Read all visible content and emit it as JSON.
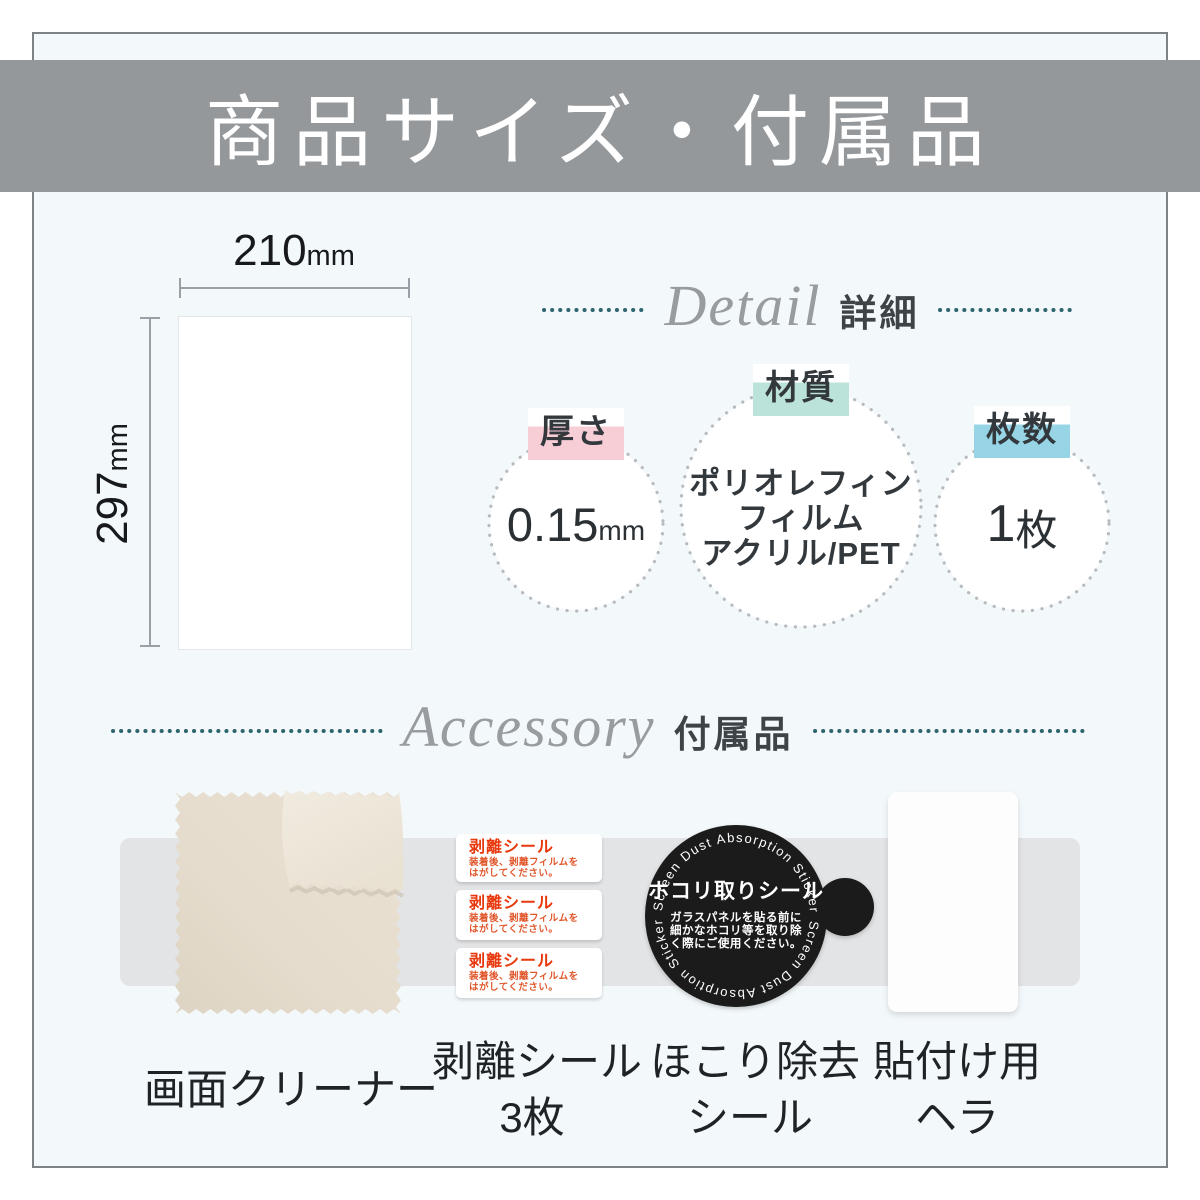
{
  "title": "商品サイズ・付属品",
  "size_diagram": {
    "width_value": "210",
    "width_unit": "mm",
    "height_value": "297",
    "height_unit": "mm"
  },
  "detail": {
    "script_title": "Detail",
    "heading": "詳細",
    "specs": [
      {
        "label": "厚さ",
        "value": "0.15",
        "unit": "mm",
        "highlight_color": "#f7cdd6"
      },
      {
        "label": "材質",
        "lines": [
          "ポリオレフィン",
          "フィルム",
          "アクリル/PET"
        ],
        "highlight_color": "#bce3d9"
      },
      {
        "label": "枚数",
        "value": "1",
        "unit": "枚",
        "highlight_color": "#97d4e5"
      }
    ]
  },
  "accessory": {
    "script_title": "Accessory",
    "heading": "付属品",
    "items": [
      {
        "line1": "画面クリーナー",
        "line2": ""
      },
      {
        "line1": "剥離シール",
        "line2": "3枚"
      },
      {
        "line1": "ほこり除去",
        "line2": "シール"
      },
      {
        "line1": "貼付け用",
        "line2": "ヘラ"
      }
    ]
  },
  "release_sticker": {
    "title": "剥離シール",
    "body_line1": "装着後、剥離フィルムを",
    "body_line2": "はがしてください。"
  },
  "dust_sticker": {
    "curved_text": "Screen Dust Absorption Sticker",
    "title": "ホコリ取りシール",
    "body_lines": [
      "ガラスパネルを貼る前に",
      "細かなホコリ等を取り除",
      "く際にご使用ください。"
    ]
  },
  "colors": {
    "header_band": "#95989b",
    "accent_dots": "#2d6570",
    "pink_highlight": "#f7cdd6",
    "mint_highlight": "#bce3d9",
    "cyan_highlight": "#97d4e5",
    "sticker_red": "#e8380d",
    "dust_sticker_bg": "#1b1b1b",
    "page_inner_bg": "#f3f8fb"
  }
}
